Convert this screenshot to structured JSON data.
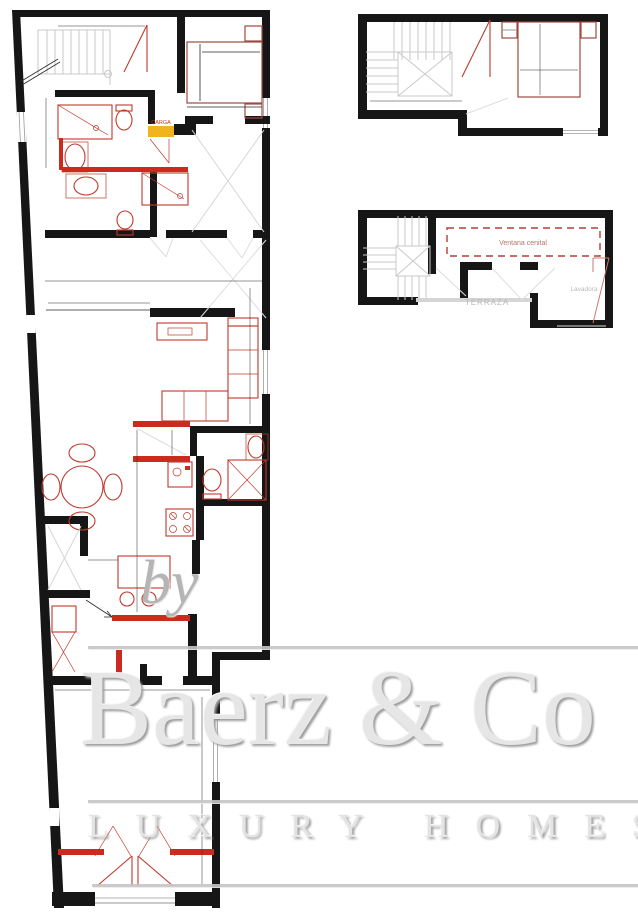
{
  "colors": {
    "wall_black": "#161616",
    "furniture_red": "#c0392b",
    "door_red": "#cc2a1f",
    "bed_brown": "#9e4a42",
    "stair_gray": "#c9c9c9",
    "carga_yellow": "#f0b41e",
    "skylight_dashed_red": "#b04038",
    "watermark_gray": "#c6c6c6"
  },
  "plan_labels": {
    "carga": "CARGA",
    "ventana_cenital": "Ventana cenital",
    "terraza": "TERRAZA",
    "lavadora": "Lavadora"
  },
  "watermark": {
    "prefix": "by",
    "brand": "Baerz & Co",
    "tagline": "LUXURY HOMES"
  }
}
